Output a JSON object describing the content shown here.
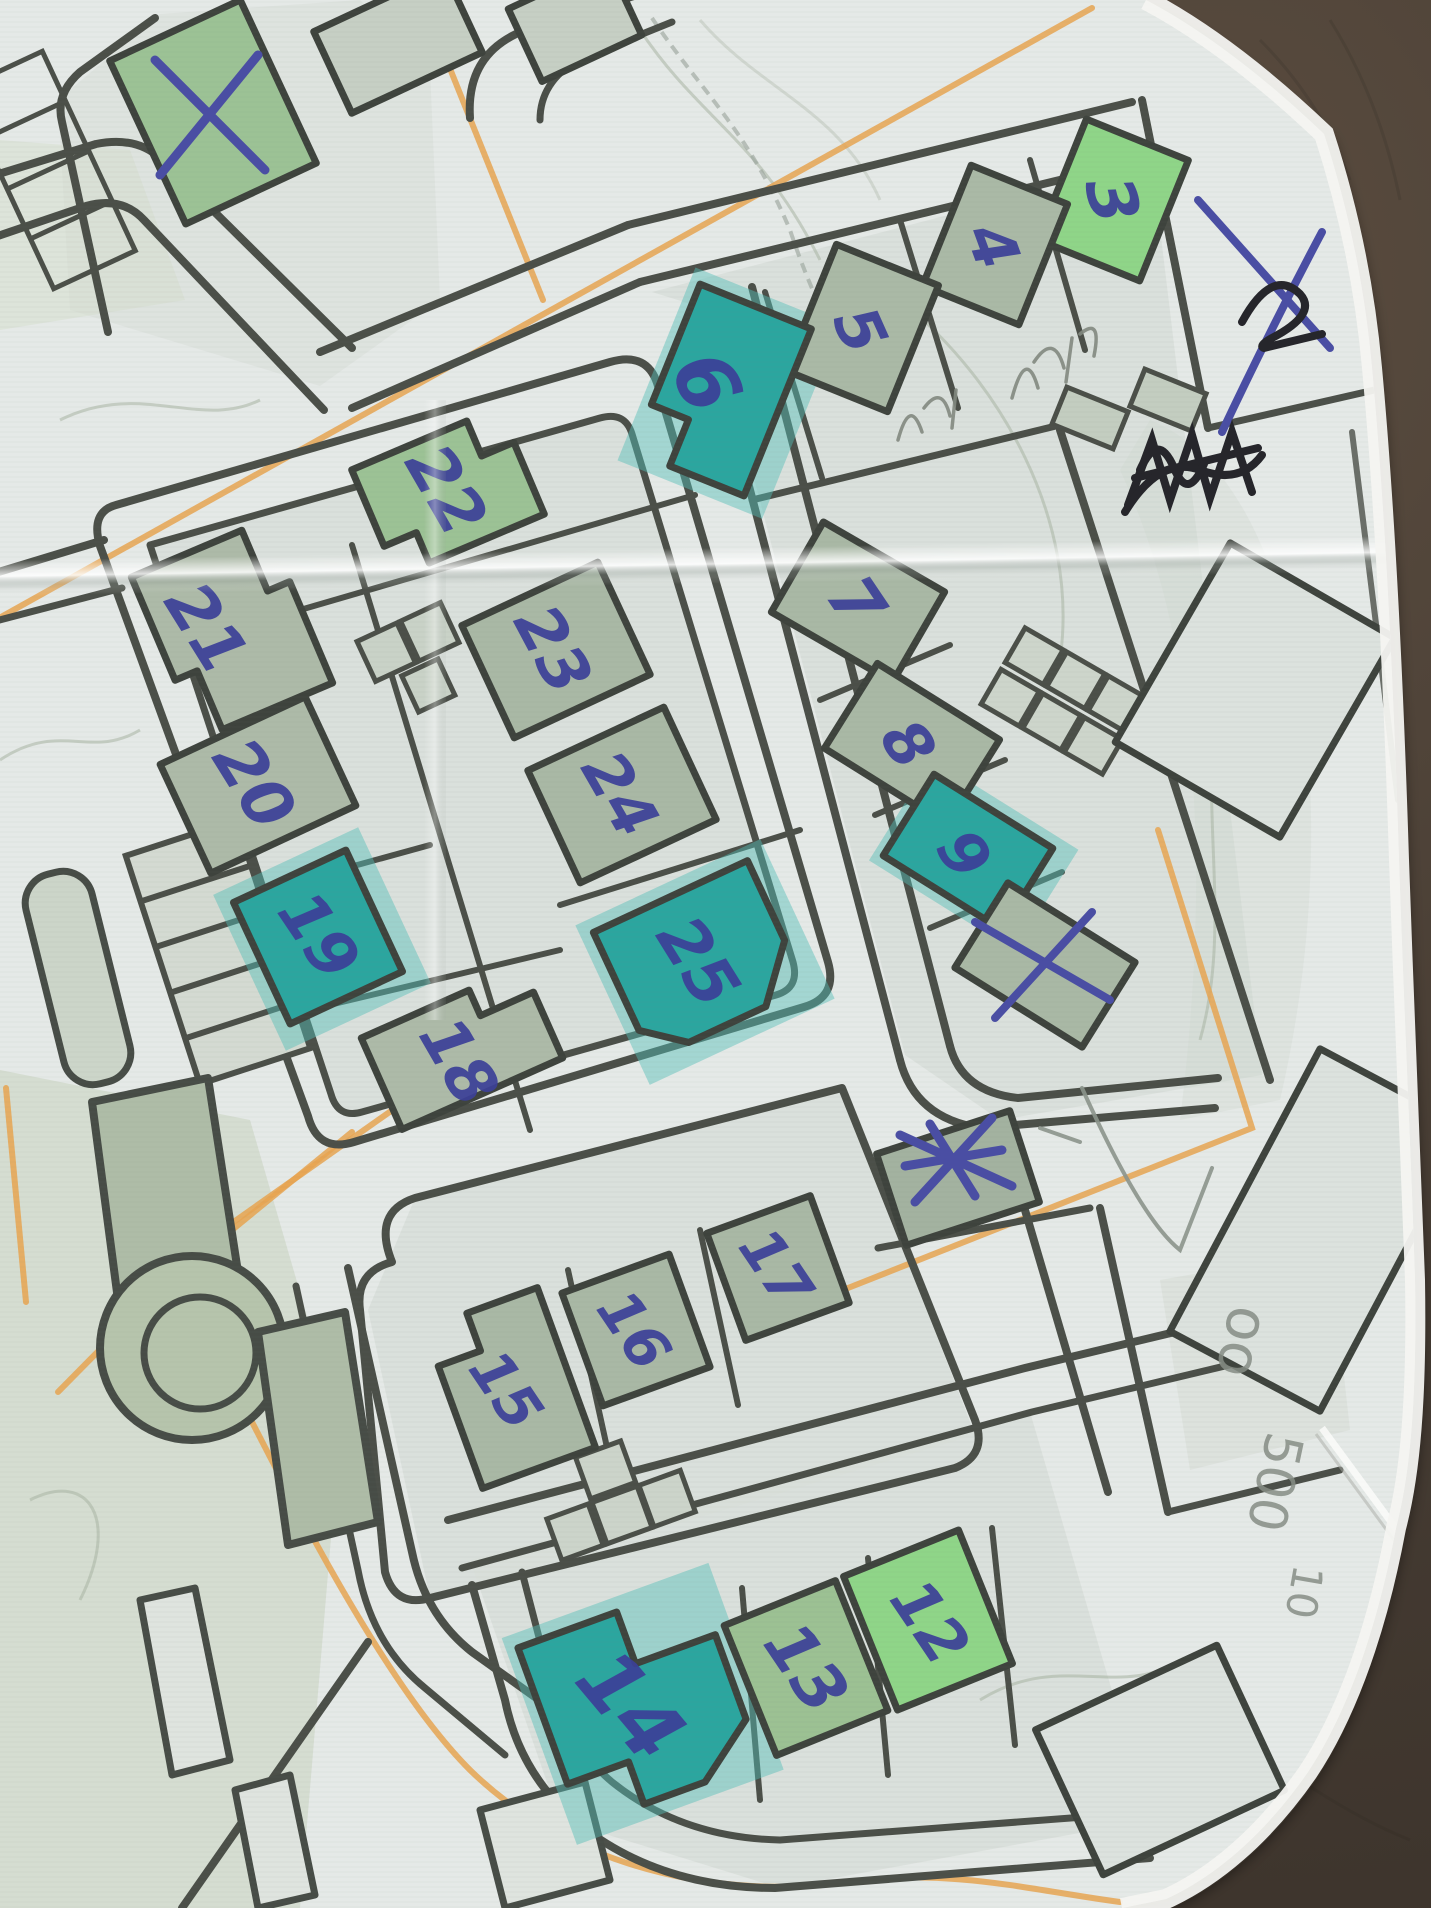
{
  "scene": {
    "description": "Photograph of a paper street map (orienteering style) lying on a dark brown surface, annotated by hand with blue ballpoint numbers on buildings, blue X cross-outs, orange pencil route lines and faint graphite notes",
    "background_color": "#453b32",
    "paper_color": "#e9eceb"
  },
  "colors": {
    "pen_blue": "#3c4098",
    "pencil_orange": "#e7a451",
    "pencil_gray": "#868d85",
    "pen_black": "#26262b",
    "road_dark": "#4b4f48",
    "building_sage": "#adbaa8",
    "building_bright_green": "#8fd588",
    "highlight_teal": "#2ba69f"
  },
  "building_labels": [
    {
      "text": "3",
      "x": 1112,
      "y": 200,
      "rot": 76,
      "size": 66
    },
    {
      "text": "4",
      "x": 993,
      "y": 246,
      "rot": 70,
      "size": 62
    },
    {
      "text": "5",
      "x": 860,
      "y": 330,
      "rot": 66,
      "size": 62
    },
    {
      "text": "6",
      "x": 706,
      "y": 382,
      "rot": 64,
      "size": 80
    },
    {
      "text": "7",
      "x": 856,
      "y": 602,
      "rot": 56,
      "size": 66
    },
    {
      "text": "8",
      "x": 908,
      "y": 744,
      "rot": 58,
      "size": 62
    },
    {
      "text": "9",
      "x": 964,
      "y": 854,
      "rot": 58,
      "size": 62
    },
    {
      "text": "12",
      "x": 930,
      "y": 1622,
      "rot": 56,
      "size": 62
    },
    {
      "text": "13",
      "x": 806,
      "y": 1668,
      "rot": 56,
      "size": 66
    },
    {
      "text": "14",
      "x": 630,
      "y": 1706,
      "rot": 50,
      "size": 82
    },
    {
      "text": "15",
      "x": 506,
      "y": 1390,
      "rot": 56,
      "size": 58
    },
    {
      "text": "16",
      "x": 634,
      "y": 1330,
      "rot": 56,
      "size": 58
    },
    {
      "text": "17",
      "x": 776,
      "y": 1268,
      "rot": 56,
      "size": 58
    },
    {
      "text": "18",
      "x": 458,
      "y": 1062,
      "rot": 60,
      "size": 64
    },
    {
      "text": "19",
      "x": 318,
      "y": 936,
      "rot": 56,
      "size": 64
    },
    {
      "text": "20",
      "x": 254,
      "y": 784,
      "rot": 58,
      "size": 66
    },
    {
      "text": "21",
      "x": 206,
      "y": 628,
      "rot": 58,
      "size": 66
    },
    {
      "text": "22",
      "x": 446,
      "y": 490,
      "rot": 60,
      "size": 66
    },
    {
      "text": "23",
      "x": 552,
      "y": 650,
      "rot": 62,
      "size": 64
    },
    {
      "text": "24",
      "x": 620,
      "y": 794,
      "rot": 60,
      "size": 62
    },
    {
      "text": "25",
      "x": 698,
      "y": 962,
      "rot": 58,
      "size": 66
    }
  ],
  "highlighted_teal_buildings": [
    "6",
    "9",
    "14",
    "19",
    "25"
  ],
  "pen_marks": [
    {
      "type": "x-cross",
      "color": "blue",
      "location": "green building top-left corner of map"
    },
    {
      "type": "x-cross",
      "color": "blue",
      "location": "building directly below building 9"
    },
    {
      "type": "x-scribble",
      "color": "blue",
      "location": "small building left of building 17"
    },
    {
      "type": "scribbled-out-word",
      "color": "black",
      "location": "right of block with 7-9"
    },
    {
      "type": "mark-crossed-with-x",
      "color": "black and blue",
      "location": "right paper margin near buildings 3-4"
    }
  ],
  "pencil_notes": [
    {
      "text": "oo",
      "x": 1243,
      "y": 1342,
      "rot": 102,
      "size": 58
    },
    {
      "text": "500",
      "x": 1274,
      "y": 1482,
      "rot": 102,
      "size": 52
    },
    {
      "text": "10",
      "x": 1304,
      "y": 1592,
      "rot": 100,
      "size": 42
    }
  ]
}
